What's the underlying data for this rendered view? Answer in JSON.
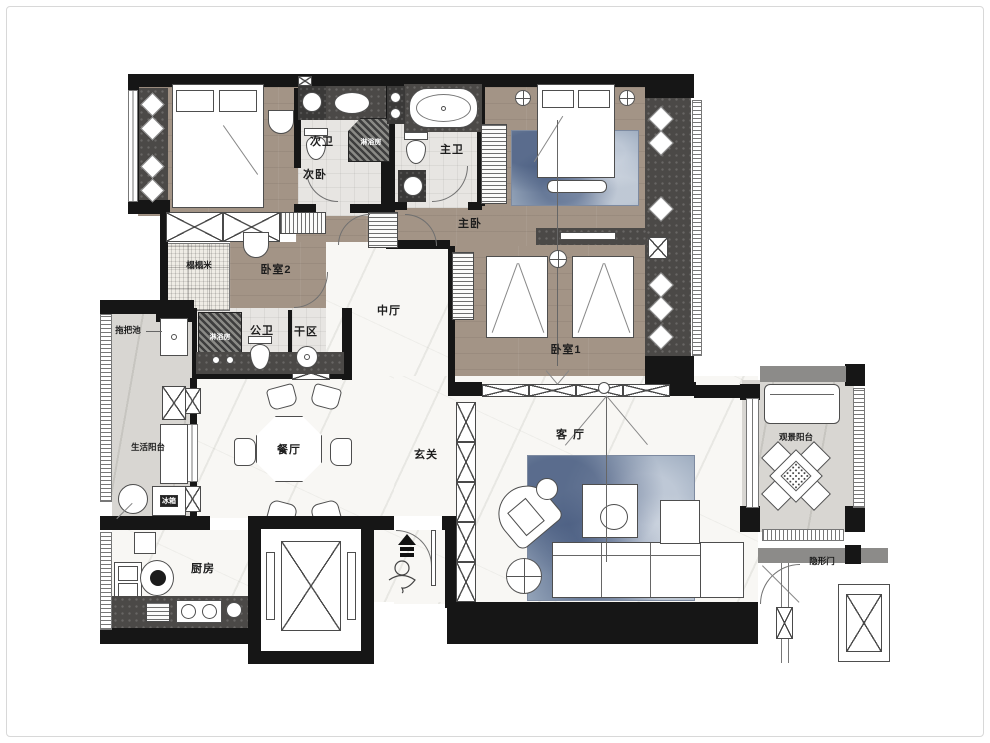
{
  "plan": {
    "type": "apartment floor plan",
    "rooms": {
      "ciwo": {
        "label": "次卧"
      },
      "ciwei": {
        "label": "次卫"
      },
      "zhuwei": {
        "label": "主卫"
      },
      "zhuwo": {
        "label": "主卧"
      },
      "woshi2": {
        "label": "卧室2"
      },
      "tatami": {
        "label": "榻榻米"
      },
      "gongwei": {
        "label": "公卫"
      },
      "ganqu": {
        "label": "干区"
      },
      "zhongting": {
        "label": "中厅"
      },
      "woshi1": {
        "label": "卧室1"
      },
      "shenghuoyangtai": {
        "label": "生活阳台"
      },
      "canting": {
        "label": "餐厅"
      },
      "xuanguan": {
        "label": "玄关"
      },
      "keting": {
        "label": "客厅"
      },
      "guanjingyangtai": {
        "label": "观景阳台"
      },
      "chufang": {
        "label": "厨房"
      }
    },
    "annotations": {
      "mop_pool": {
        "label": "拖把池"
      },
      "fridge": {
        "label": "冰箱"
      },
      "shower_room": {
        "label": "淋浴房"
      },
      "hidden_door": {
        "label": "隐形门"
      }
    },
    "colors": {
      "wall": "#161616",
      "wood_floor": "#a39486",
      "marble_floor": "#f8f7f4",
      "stone_floor": "#d8d6d2",
      "dark_counter": "#4b4947",
      "rug_blue": "#8fa0b6",
      "tile": "#e7e5e2"
    }
  }
}
